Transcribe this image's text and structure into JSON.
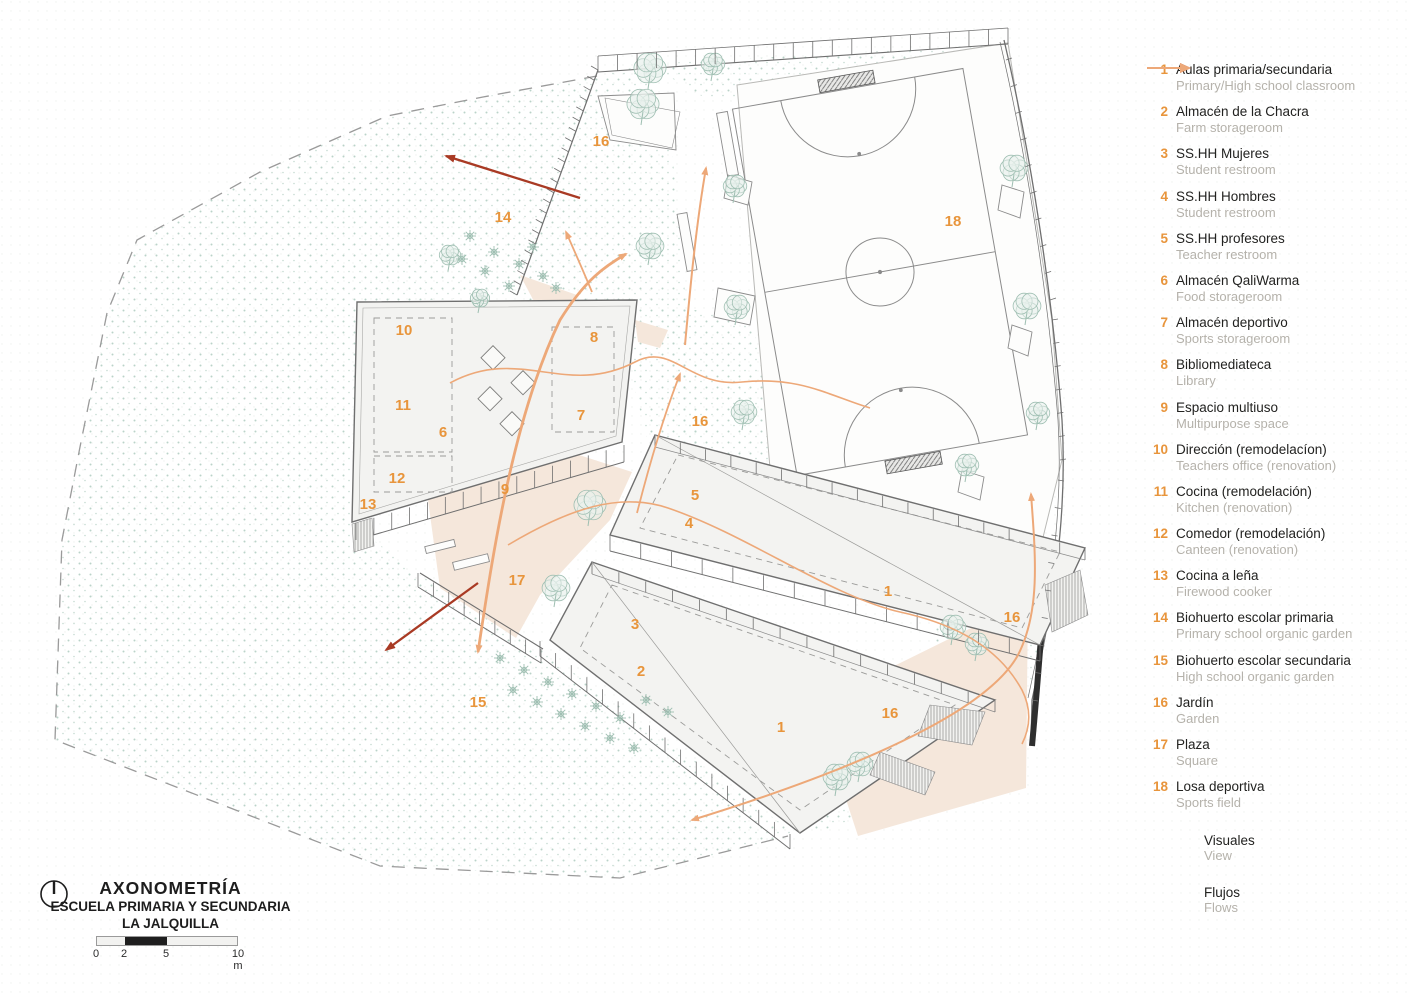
{
  "title_block": {
    "title": "AXONOMETRÍA",
    "subtitle1": "ESCUELA PRIMARIA Y SECUNDARIA",
    "subtitle2": "LA JALQUILLA",
    "scale": {
      "labels": [
        "0",
        "2",
        "5",
        "10 m"
      ]
    }
  },
  "legend": {
    "items": [
      {
        "num": "1",
        "es": "Aulas primaria/secundaria",
        "en": "Primary/High school classroom"
      },
      {
        "num": "2",
        "es": "Almacén de la Chacra",
        "en": "Farm storageroom"
      },
      {
        "num": "3",
        "es": "SS.HH Mujeres",
        "en": "Student restroom"
      },
      {
        "num": "4",
        "es": "SS.HH Hombres",
        "en": "Student restroom"
      },
      {
        "num": "5",
        "es": "SS.HH profesores",
        "en": "Teacher restroom"
      },
      {
        "num": "6",
        "es": "Almacén QaliWarma",
        "en": "Food storageroom"
      },
      {
        "num": "7",
        "es": "Almacén deportivo",
        "en": "Sports storageroom"
      },
      {
        "num": "8",
        "es": "Bibliomediateca",
        "en": "Library"
      },
      {
        "num": "9",
        "es": "Espacio multiuso",
        "en": "Multipurpose space"
      },
      {
        "num": "10",
        "es": "Dirección (remodelacíon)",
        "en": "Teachers office (renovation)"
      },
      {
        "num": "11",
        "es": "Cocina (remodelación)",
        "en": "Kitchen (renovation)"
      },
      {
        "num": "12",
        "es": "Comedor (remodelación)",
        "en": "Canteen (renovation)"
      },
      {
        "num": "13",
        "es": "Cocina a leña",
        "en": "Firewood cooker"
      },
      {
        "num": "14",
        "es": "Biohuerto escolar primaria",
        "en": "Primary school organic garden"
      },
      {
        "num": "15",
        "es": "Biohuerto escolar secundaria",
        "en": "High school organic garden"
      },
      {
        "num": "16",
        "es": "Jardín",
        "en": "Garden"
      },
      {
        "num": "17",
        "es": "Plaza",
        "en": "Square"
      },
      {
        "num": "18",
        "es": "Losa deportiva",
        "en": "Sports field"
      }
    ],
    "arrows": [
      {
        "label": "Visuales",
        "sub": "View",
        "color": "#A93A24"
      },
      {
        "label": "Flujos",
        "sub": "Flows",
        "color": "#EDA878"
      }
    ]
  },
  "plan_labels": [
    {
      "n": "16",
      "x": 601,
      "y": 146
    },
    {
      "n": "14",
      "x": 503,
      "y": 222
    },
    {
      "n": "18",
      "x": 953,
      "y": 226
    },
    {
      "n": "10",
      "x": 404,
      "y": 335
    },
    {
      "n": "8",
      "x": 594,
      "y": 342
    },
    {
      "n": "11",
      "x": 403,
      "y": 410
    },
    {
      "n": "7",
      "x": 581,
      "y": 420
    },
    {
      "n": "6",
      "x": 443,
      "y": 437
    },
    {
      "n": "16",
      "x": 700,
      "y": 426
    },
    {
      "n": "12",
      "x": 397,
      "y": 483
    },
    {
      "n": "9",
      "x": 505,
      "y": 494
    },
    {
      "n": "13",
      "x": 368,
      "y": 509
    },
    {
      "n": "5",
      "x": 695,
      "y": 500
    },
    {
      "n": "4",
      "x": 689,
      "y": 528
    },
    {
      "n": "17",
      "x": 517,
      "y": 585
    },
    {
      "n": "1",
      "x": 888,
      "y": 596
    },
    {
      "n": "3",
      "x": 635,
      "y": 629
    },
    {
      "n": "16",
      "x": 1012,
      "y": 622
    },
    {
      "n": "2",
      "x": 641,
      "y": 676
    },
    {
      "n": "15",
      "x": 478,
      "y": 707
    },
    {
      "n": "16",
      "x": 890,
      "y": 718
    },
    {
      "n": "1",
      "x": 781,
      "y": 732
    }
  ],
  "colors": {
    "accent_orange": "#E8953C",
    "flow": "#EDA878",
    "visual": "#A93A24",
    "tree": "#9FBFB2",
    "dots": "#AFCBBF",
    "peach": "#F5E7DB",
    "line": "#8B8B8B"
  }
}
